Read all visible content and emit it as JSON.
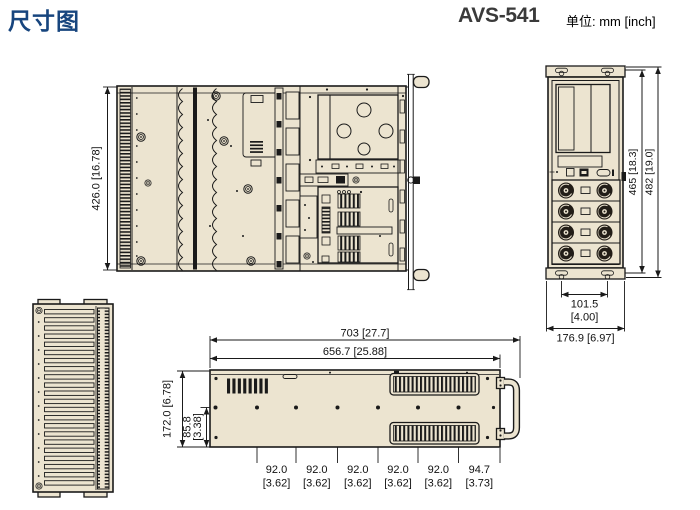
{
  "header": {
    "title": "尺寸图",
    "model": "AVS-541",
    "units": "单位: mm [inch]"
  },
  "colors": {
    "accent_blue": "#17457E",
    "line_black": "#1A1A1A",
    "panel_beige": "#ECE4D0",
    "model_gray": "#3A3A3A"
  },
  "top_view": {
    "depth_dim": "426.0 [16.78]"
  },
  "rear_view": {
    "width_inner_dim": "465 [18.3]",
    "width_outer_dim": "482 [19.0]",
    "foot_span_mm": "101.5",
    "foot_span_inch": "[4.00]",
    "depth_dim": "176.9 [6.97]"
  },
  "side_view": {
    "length_overall_dim": "703 [27.7]",
    "length_body_dim": "656.7 [25.88]",
    "height_dim": "172.0 [6.78]",
    "hole_offset_mm": "85.8",
    "hole_offset_inch": "[3.38]",
    "hole_pitches": [
      {
        "mm": "92.0",
        "inch": "[3.62]"
      },
      {
        "mm": "92.0",
        "inch": "[3.62]"
      },
      {
        "mm": "92.0",
        "inch": "[3.62]"
      },
      {
        "mm": "92.0",
        "inch": "[3.62]"
      },
      {
        "mm": "92.0",
        "inch": "[3.62]"
      },
      {
        "mm": "94.7",
        "inch": "[3.73]"
      }
    ]
  }
}
